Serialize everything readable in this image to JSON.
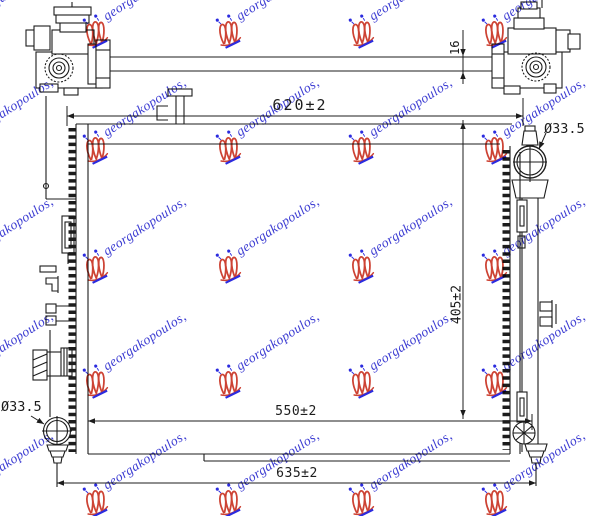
{
  "page": {
    "background": "#ffffff",
    "line_color": "#1c1c1c"
  },
  "drawing": {
    "type": "radiator-technical-line-drawing",
    "dimensions": {
      "top_width": "620±2",
      "crossbar_thickness": "16",
      "filler_cap_diameter": "Ø33.5",
      "height": "405±2",
      "core_width": "550±2",
      "overall_width": "635±2",
      "drain_plug_diameter": "Ø33.5"
    }
  },
  "watermark": {
    "text": "georgakopoulos,",
    "logo": "georgakopoulos-crest-logo",
    "text_color": "#3c3cd2",
    "logo_color": "#cd4334",
    "accent_color": "#2b2bdf",
    "grid": {
      "cols": [
        -51,
        82,
        215,
        348,
        481,
        614
      ],
      "rows": [
        14,
        130,
        249,
        364,
        483
      ],
      "rotation_deg": -33
    }
  }
}
